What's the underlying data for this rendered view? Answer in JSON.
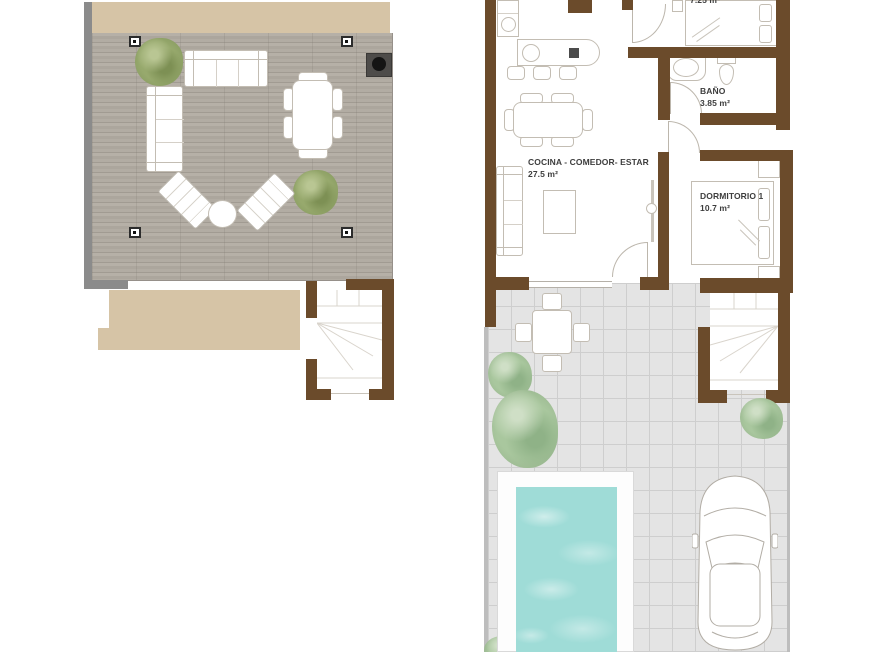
{
  "ground_floor": {
    "kitchen_living": {
      "label": "COCINA - COMEDOR- ESTAR",
      "area": "27.5 m²"
    },
    "bathroom": {
      "label": "BAÑO",
      "area": "3.85 m²"
    },
    "bedroom_1": {
      "label": "DORMITORIO 1",
      "area": "10.7 m²"
    },
    "bedroom_2": {
      "area": "7.25 m²"
    }
  },
  "colors": {
    "wall_brown": "#6b4b2b",
    "terrace_wall_gray": "#8b8b8b",
    "roof_beige": "#d6c4a6",
    "deck_wood_gray": "#b0aaa1",
    "patio_tile_gray": "#e4e4e4",
    "pool_water_turquoise": "#9fdcd7",
    "plant_olive_green": "#97a96d",
    "tree_sage_green": "#a9c79e"
  }
}
